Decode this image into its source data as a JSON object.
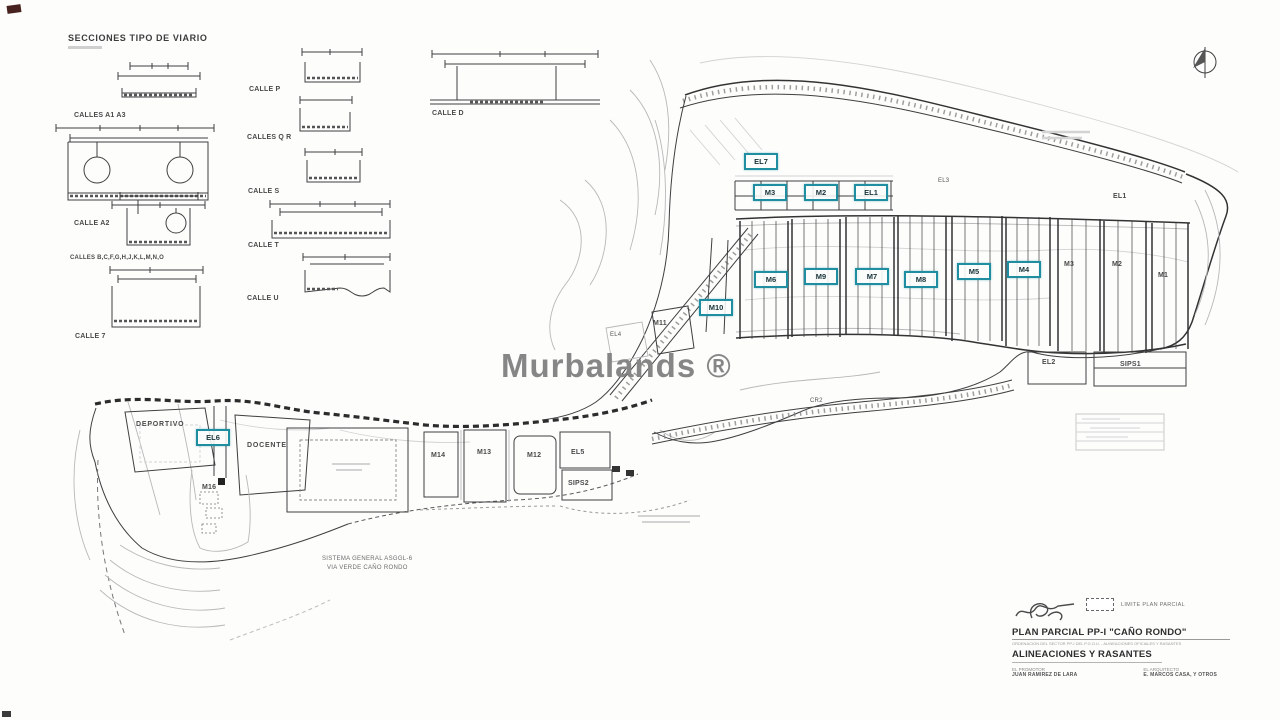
{
  "header": {
    "title": "SECCIONES TIPO DE VIARIO"
  },
  "street_sections": {
    "col1": [
      "CALLES A1 A3",
      "CALLE A2",
      "CALLES B,C,F,G,H,J,K,L,M,N,O",
      "CALLE 7"
    ],
    "col2": [
      "CALLE P",
      "CALLES Q R",
      "CALLE S",
      "CALLE T",
      "CALLE U"
    ],
    "col3": [
      "CALLE D"
    ]
  },
  "watermark": "Murbalands ®",
  "map": {
    "accent_color": "#1f8ea1",
    "boxed_labels": [
      {
        "text": "EL7"
      },
      {
        "text": "M3"
      },
      {
        "text": "M2"
      },
      {
        "text": "EL1"
      },
      {
        "text": "M6"
      },
      {
        "text": "M9"
      },
      {
        "text": "M7"
      },
      {
        "text": "M8"
      },
      {
        "text": "M5"
      },
      {
        "text": "M4"
      },
      {
        "text": "M10"
      },
      {
        "text": "EL6"
      }
    ],
    "labels": [
      {
        "text": "M11"
      },
      {
        "text": "EL4"
      },
      {
        "text": "EL3"
      },
      {
        "text": "EL1"
      },
      {
        "text": "M3"
      },
      {
        "text": "M2"
      },
      {
        "text": "M1"
      },
      {
        "text": "EL2"
      },
      {
        "text": "SIPS1"
      },
      {
        "text": "DEPORTIVO"
      },
      {
        "text": "DOCENTE"
      },
      {
        "text": "M16"
      },
      {
        "text": "M14"
      },
      {
        "text": "M13"
      },
      {
        "text": "M12"
      },
      {
        "text": "EL5"
      },
      {
        "text": "SIPS2"
      },
      {
        "text": "CR2"
      }
    ],
    "note_line1": "SISTEMA GENERAL ASGGL-6",
    "note_line2": "VIA VERDE CAÑO RONDO"
  },
  "title_block": {
    "legend_label": "LIMITE PLAN PARCIAL",
    "project_title": "PLAN PARCIAL PP-I \"CAÑO RONDO\"",
    "project_subtitle": "ORDENACION DEL SECTOR PP-I DEL P.G.O.U. - ALINEACIONES OFICIALES Y RASANTES",
    "sheet_title": "ALINEACIONES Y RASANTES",
    "sign_left_role": "EL PROMOTOR",
    "sign_left_name": "JUAN RAMIREZ DE LARA",
    "sign_right_role": "EL ARQUITECTO",
    "sign_right_name": "E. MARCOS CASA, Y OTROS"
  }
}
